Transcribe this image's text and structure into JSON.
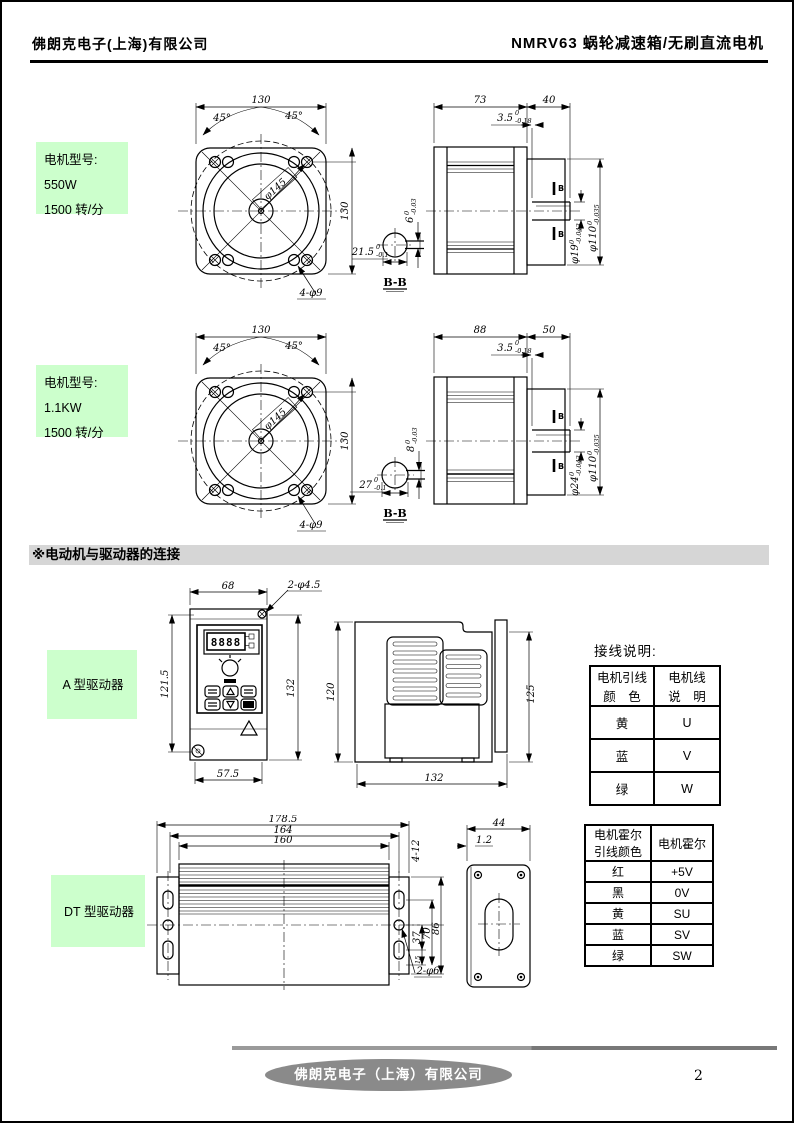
{
  "header": {
    "company": "佛朗克电子(上海)有限公司",
    "title": "NMRV63 蜗轮减速箱/无刷直流电机"
  },
  "section_title": "※电动机与驱动器的连接",
  "motor550": {
    "label": [
      "电机型号:",
      "550W",
      "1500 转/分"
    ],
    "front": {
      "width": "130",
      "height": "130",
      "angle_left": "45°",
      "angle_right": "45°",
      "bolt_circle": "φ145",
      "holes": "4-φ9",
      "key_offset": "21.5",
      "key_offset_tol_top": "0",
      "key_offset_tol_bot": "-0.1"
    },
    "section_view": {
      "label": "B-B",
      "key_width": "6",
      "key_width_tol_top": "0",
      "key_width_tol_bot": "-0.03"
    },
    "side": {
      "body_len": "73",
      "shaft_len": "40",
      "key_len": "3.5",
      "key_len_tol_top": "0",
      "key_len_tol_bot": "-0.18",
      "spigot_dia": "φ110",
      "spigot_tol_top": "0",
      "spigot_tol_bot": "-0.035",
      "shaft_dia": "φ19",
      "shaft_dia_tol_top": "0",
      "shaft_dia_tol_bot": "-0.043",
      "marker_top": "B",
      "marker_bot": "B"
    }
  },
  "motor1100": {
    "label": [
      "电机型号:",
      "1.1KW",
      "1500 转/分"
    ],
    "front": {
      "width": "130",
      "height": "130",
      "angle_left": "45°",
      "angle_right": "45°",
      "bolt_circle": "φ145",
      "holes": "4-φ9",
      "key_offset": "27",
      "key_offset_tol_top": "0",
      "key_offset_tol_bot": "-0.1"
    },
    "section_view": {
      "label": "B-B",
      "key_width": "8",
      "key_width_tol_top": "0",
      "key_width_tol_bot": "-0.03"
    },
    "side": {
      "body_len": "88",
      "shaft_len": "50",
      "key_len": "3.5",
      "key_len_tol_top": "0",
      "key_len_tol_bot": "-0.18",
      "spigot_dia": "φ110",
      "spigot_tol_top": "0",
      "spigot_tol_bot": "-0.035",
      "shaft_dia": "φ24",
      "shaft_dia_tol_top": "0",
      "shaft_dia_tol_bot": "-0.043",
      "marker_top": "B",
      "marker_bot": "B"
    }
  },
  "driverA": {
    "label": "A 型驱动器",
    "display_digits": "8888",
    "dims": {
      "width": "68",
      "holes": "2-φ4.5",
      "height_left": "121.5",
      "height_right": "132",
      "bottom_width": "57.5",
      "side_height_left": "120",
      "side_height_right": "125",
      "side_width": "132"
    }
  },
  "wiring": {
    "title": "接线说明:",
    "table": {
      "col1_header": [
        "电机引线",
        "颜　色"
      ],
      "col2_header": [
        "电机线",
        "说　明"
      ],
      "rows": [
        [
          "黄",
          "U"
        ],
        [
          "蓝",
          "V"
        ],
        [
          "绿",
          "W"
        ]
      ]
    }
  },
  "driverDT": {
    "label": "DT 型驱动器",
    "dims": {
      "overall_width": "178.5",
      "mid_width": "164",
      "inner_width": "160",
      "slots": "4-12",
      "dim_37": "37",
      "dim_15": "15",
      "dim_70": "70",
      "dim_86": "86",
      "holes": "2-φ6",
      "side_width": "44",
      "side_thickness": "1.2"
    }
  },
  "hall_table": {
    "col1_header": [
      "电机霍尔",
      "引线颜色"
    ],
    "col2_header": "电机霍尔",
    "rows": [
      [
        "红",
        "+5V"
      ],
      [
        "黑",
        "0V"
      ],
      [
        "黄",
        "SU"
      ],
      [
        "蓝",
        "SV"
      ],
      [
        "绿",
        "SW"
      ]
    ]
  },
  "footer": {
    "company": "佛朗克电子（上海）有限公司",
    "page": "2"
  }
}
